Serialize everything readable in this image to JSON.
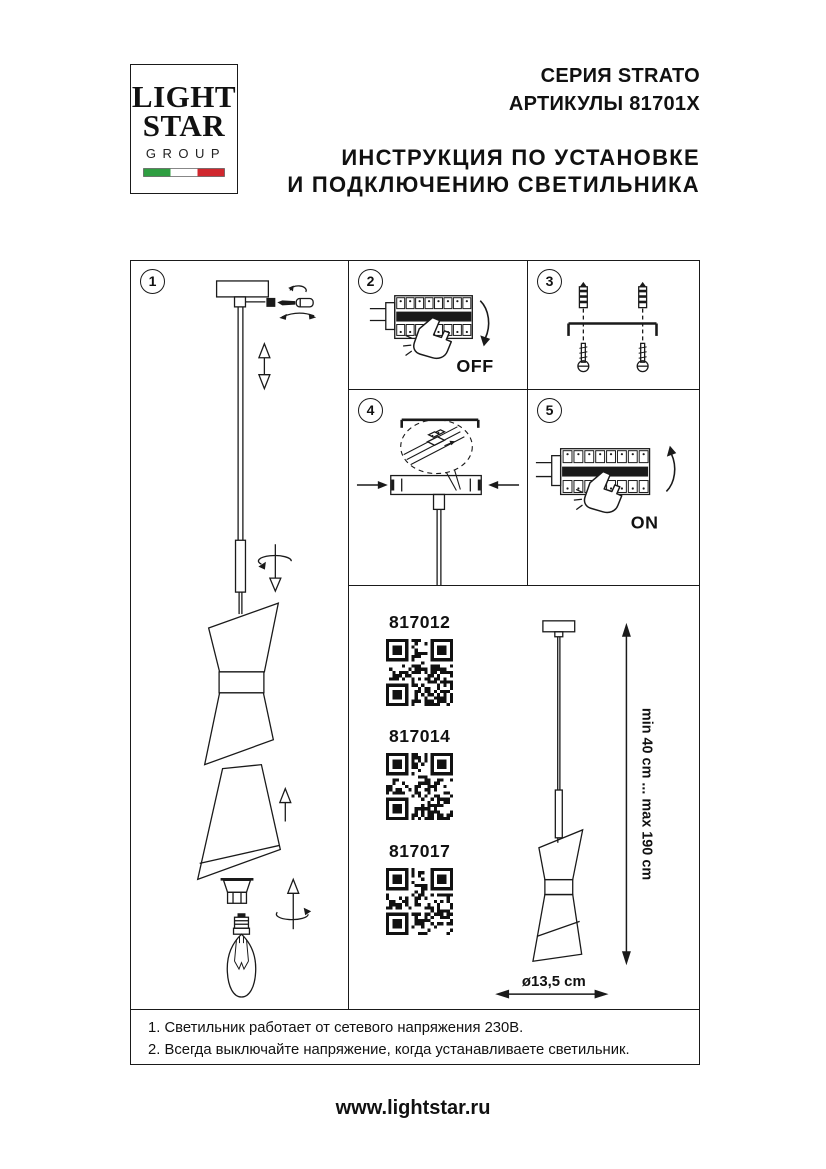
{
  "logo": {
    "line1": "LIGHT",
    "line2": "STAR",
    "line3": "GROUP",
    "flag_green": "#2f9e41",
    "flag_white": "#ffffff",
    "flag_red": "#d0272e"
  },
  "header": {
    "series": "СЕРИЯ STRATO",
    "articles": "АРТИКУЛЫ 81701X",
    "title_line1": "ИНСТРУКЦИЯ ПО УСТАНОВКЕ",
    "title_line2": "И ПОДКЛЮЧЕНИЮ СВЕТИЛЬНИКА"
  },
  "steps": {
    "n1": "1",
    "n2": "2",
    "n3": "3",
    "n4": "4",
    "n5": "5"
  },
  "labels": {
    "off": "OFF",
    "on": "ON"
  },
  "products": [
    {
      "article": "817012"
    },
    {
      "article": "817014"
    },
    {
      "article": "817017"
    }
  ],
  "dimensions": {
    "height_range": "min 40 cm ... max 190 cm",
    "diameter": "ø13,5 cm"
  },
  "notes": {
    "line1": "1. Светильник работает от сетевого напряжения 230В.",
    "line2": "2. Всегда выключайте напряжение, когда устанавливаете светильник."
  },
  "footer": {
    "website": "www.lightstar.ru"
  }
}
